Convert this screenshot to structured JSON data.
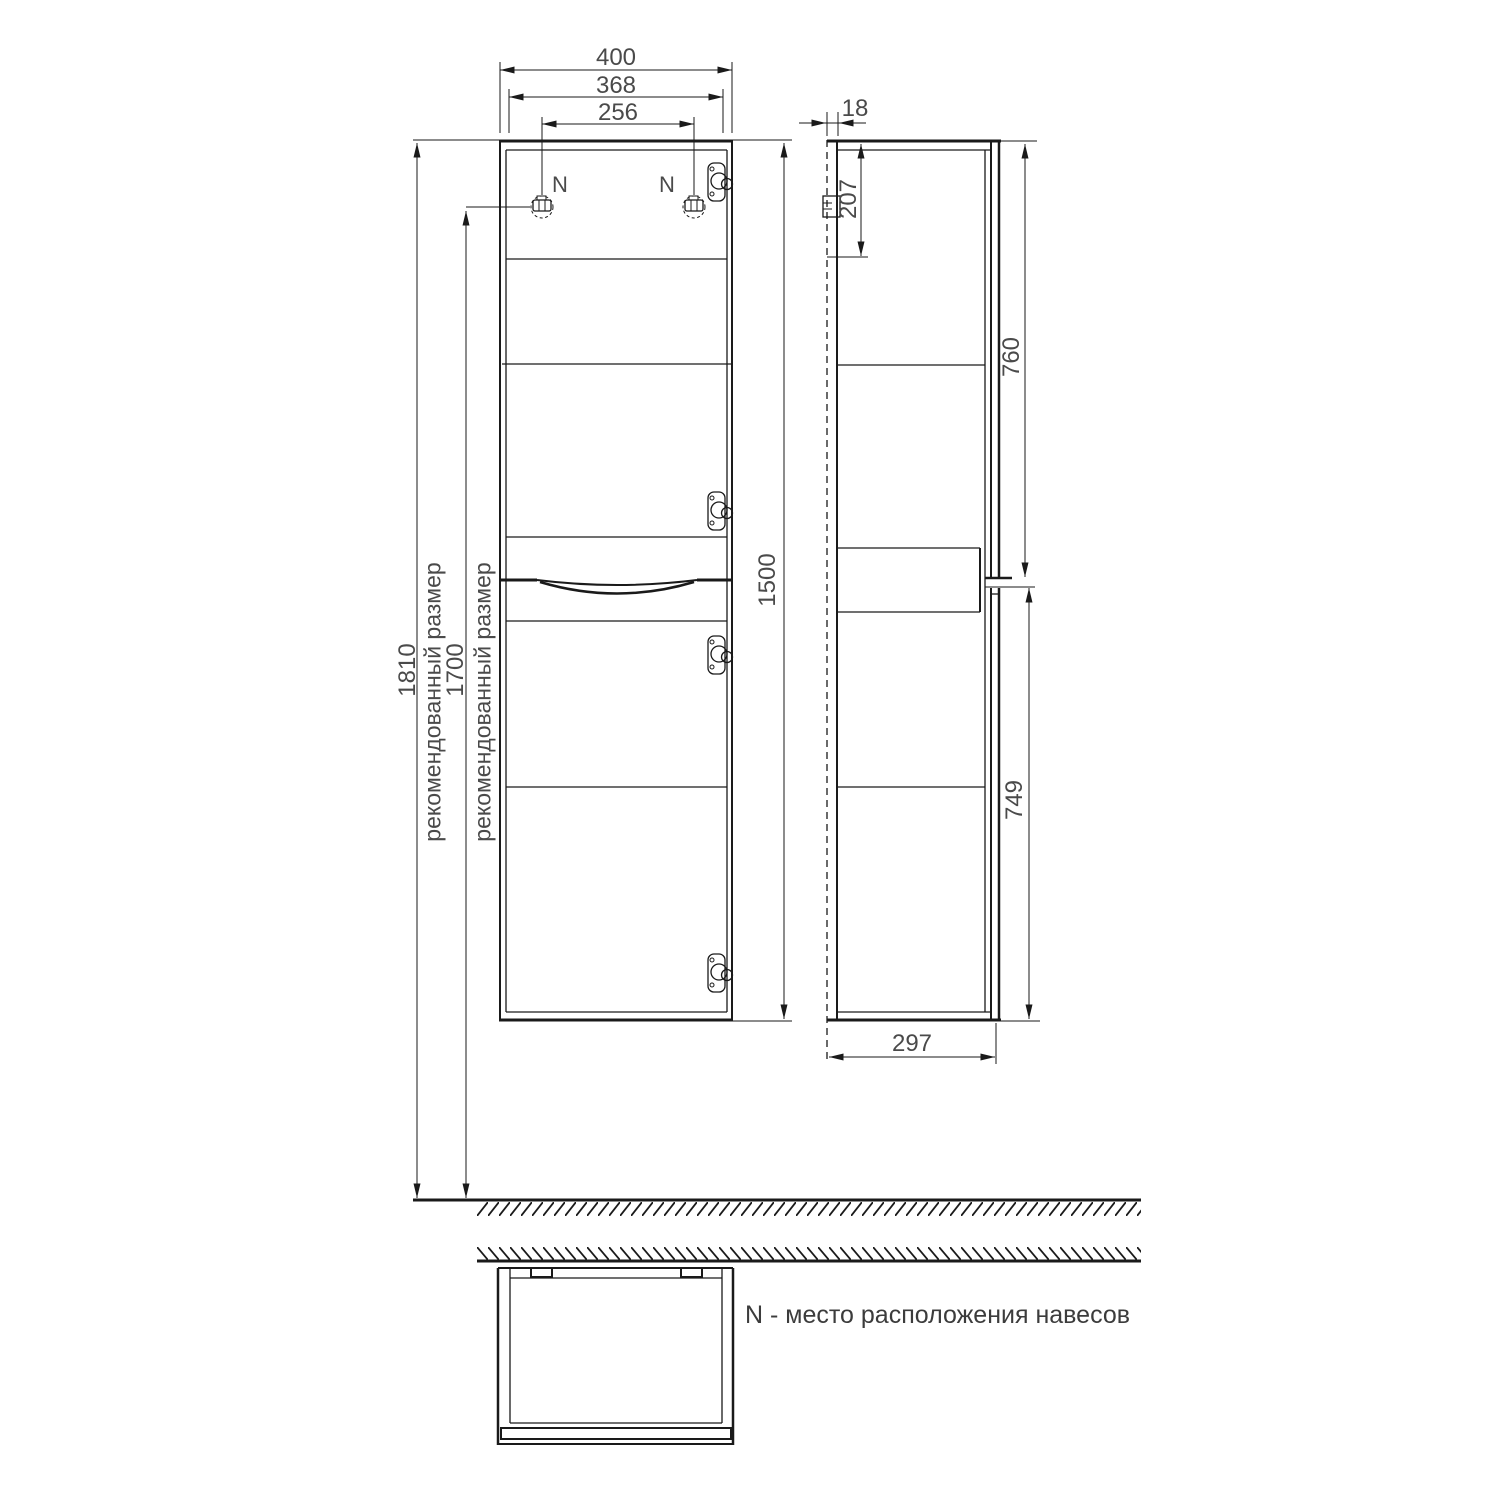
{
  "legend": "N - место расположения навесов",
  "mount_labels": {
    "left": "N",
    "right": "N"
  },
  "dims": {
    "w400": "400",
    "w368": "368",
    "w256": "256",
    "t18": "18",
    "h207": "207",
    "h760": "760",
    "h1500": "1500",
    "h749": "749",
    "d297": "297",
    "h1810": "1810",
    "h1700": "1700"
  },
  "labels": {
    "recommended_1810": "рекомендованный размер",
    "recommended_1700": "рекомендованный размер"
  },
  "colors": {
    "line": "#1a1a1a",
    "dim_text": "#4a4a4a",
    "background": "#ffffff"
  }
}
